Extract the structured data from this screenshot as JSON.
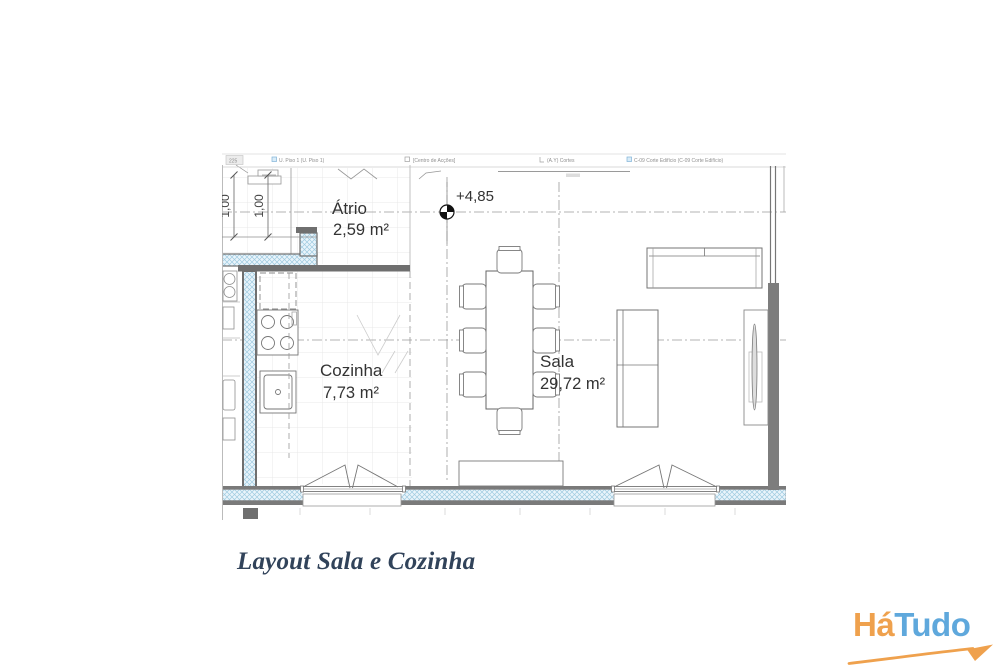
{
  "page": {
    "background": "#ffffff"
  },
  "floorplan": {
    "toolbar": {
      "ref_box": "225",
      "labels": [
        "U. Piso 1 (U. Piso 1)",
        "[Centro de Acções]",
        "(A.Y) Cortes",
        "C-09 Corte Edifício (C-09 Corte Edifício)"
      ]
    },
    "level_marker": {
      "value": "+4,85"
    },
    "dimensions": [
      {
        "value": "1,00"
      },
      {
        "value": "1,00"
      }
    ],
    "rooms": [
      {
        "name": "Átrio",
        "area": "2,59 m²"
      },
      {
        "name": "Cozinha",
        "area": "7,73 m²"
      },
      {
        "name": "Sala",
        "area": "29,72 m²"
      }
    ],
    "colors": {
      "wall": "#6f6f6f",
      "insulation_fill": "#e9f4fb",
      "insulation_hatch": "#9fcbe0",
      "drawing_line": "#767676"
    }
  },
  "caption": {
    "text": "Layout Sala e Cozinha",
    "color": "#31435a"
  },
  "logo": {
    "word_part1": "Há",
    "word_part2": "Tudo",
    "orange": "#efa14d",
    "blue": "#5fa8dc"
  }
}
